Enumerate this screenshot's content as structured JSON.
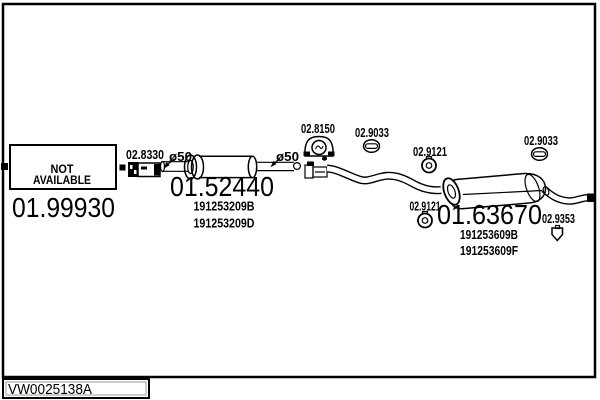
{
  "page": {
    "bg": "#ffffff",
    "line_color": "#000000"
  },
  "footer": {
    "code": "VW0025138A"
  },
  "parts": {
    "front_section": {
      "status_line1": "NOT",
      "status_line2": "AVAILABLE",
      "code": "01.99930"
    },
    "clamp_front": {
      "code": "02.8330"
    },
    "middle_silencer": {
      "code": "01.52440",
      "oe_refs": [
        "191253209B",
        "191253209D"
      ],
      "diameter_inlet": "ø50",
      "diameter_outlet": "ø50"
    },
    "clamp_mid": {
      "code": "02.8150"
    },
    "grommet_left": {
      "code": "02.9033"
    },
    "grommet_right": {
      "code": "02.9033"
    },
    "hanger_top": {
      "code": "02.9121"
    },
    "hanger_bottom": {
      "code": "02.9121"
    },
    "rear_silencer": {
      "code": "01.63670",
      "oe_refs": [
        "191253609B",
        "191253609F"
      ]
    },
    "bracket_tail": {
      "code": "02.9353"
    }
  }
}
